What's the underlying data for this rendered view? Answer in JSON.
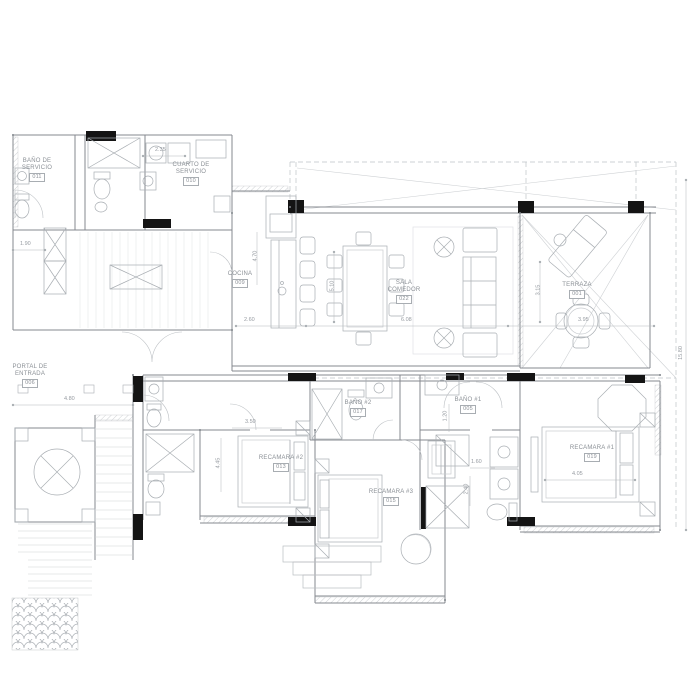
{
  "plan": {
    "rooms": [
      {
        "name": "BAÑO DE SERVICIO",
        "tag": "011"
      },
      {
        "name": "CUARTO DE SERVICIO",
        "tag": "010"
      },
      {
        "name": "COCINA",
        "tag": "009"
      },
      {
        "name": "SALA COMEDOR",
        "tag": "022"
      },
      {
        "name": "TERRAZA",
        "tag": "001"
      },
      {
        "name": "PORTAL DE ENTRADA",
        "tag": "006"
      },
      {
        "name": "BAÑO #2",
        "tag": "017"
      },
      {
        "name": "BAÑO #1",
        "tag": "005"
      },
      {
        "name": "RECAMARA #2",
        "tag": "013"
      },
      {
        "name": "RECAMARA #3",
        "tag": "015"
      },
      {
        "name": "RECAMARA #1",
        "tag": "019"
      }
    ],
    "dimensions": [
      "2.35",
      "1.90",
      "4.70",
      "5.10",
      "2.60",
      "6.08",
      "3.15",
      "3.95",
      "15.80",
      "4.80",
      "3.50",
      "4.45",
      "1.20",
      "1.60",
      "2.40",
      "4.05"
    ]
  }
}
